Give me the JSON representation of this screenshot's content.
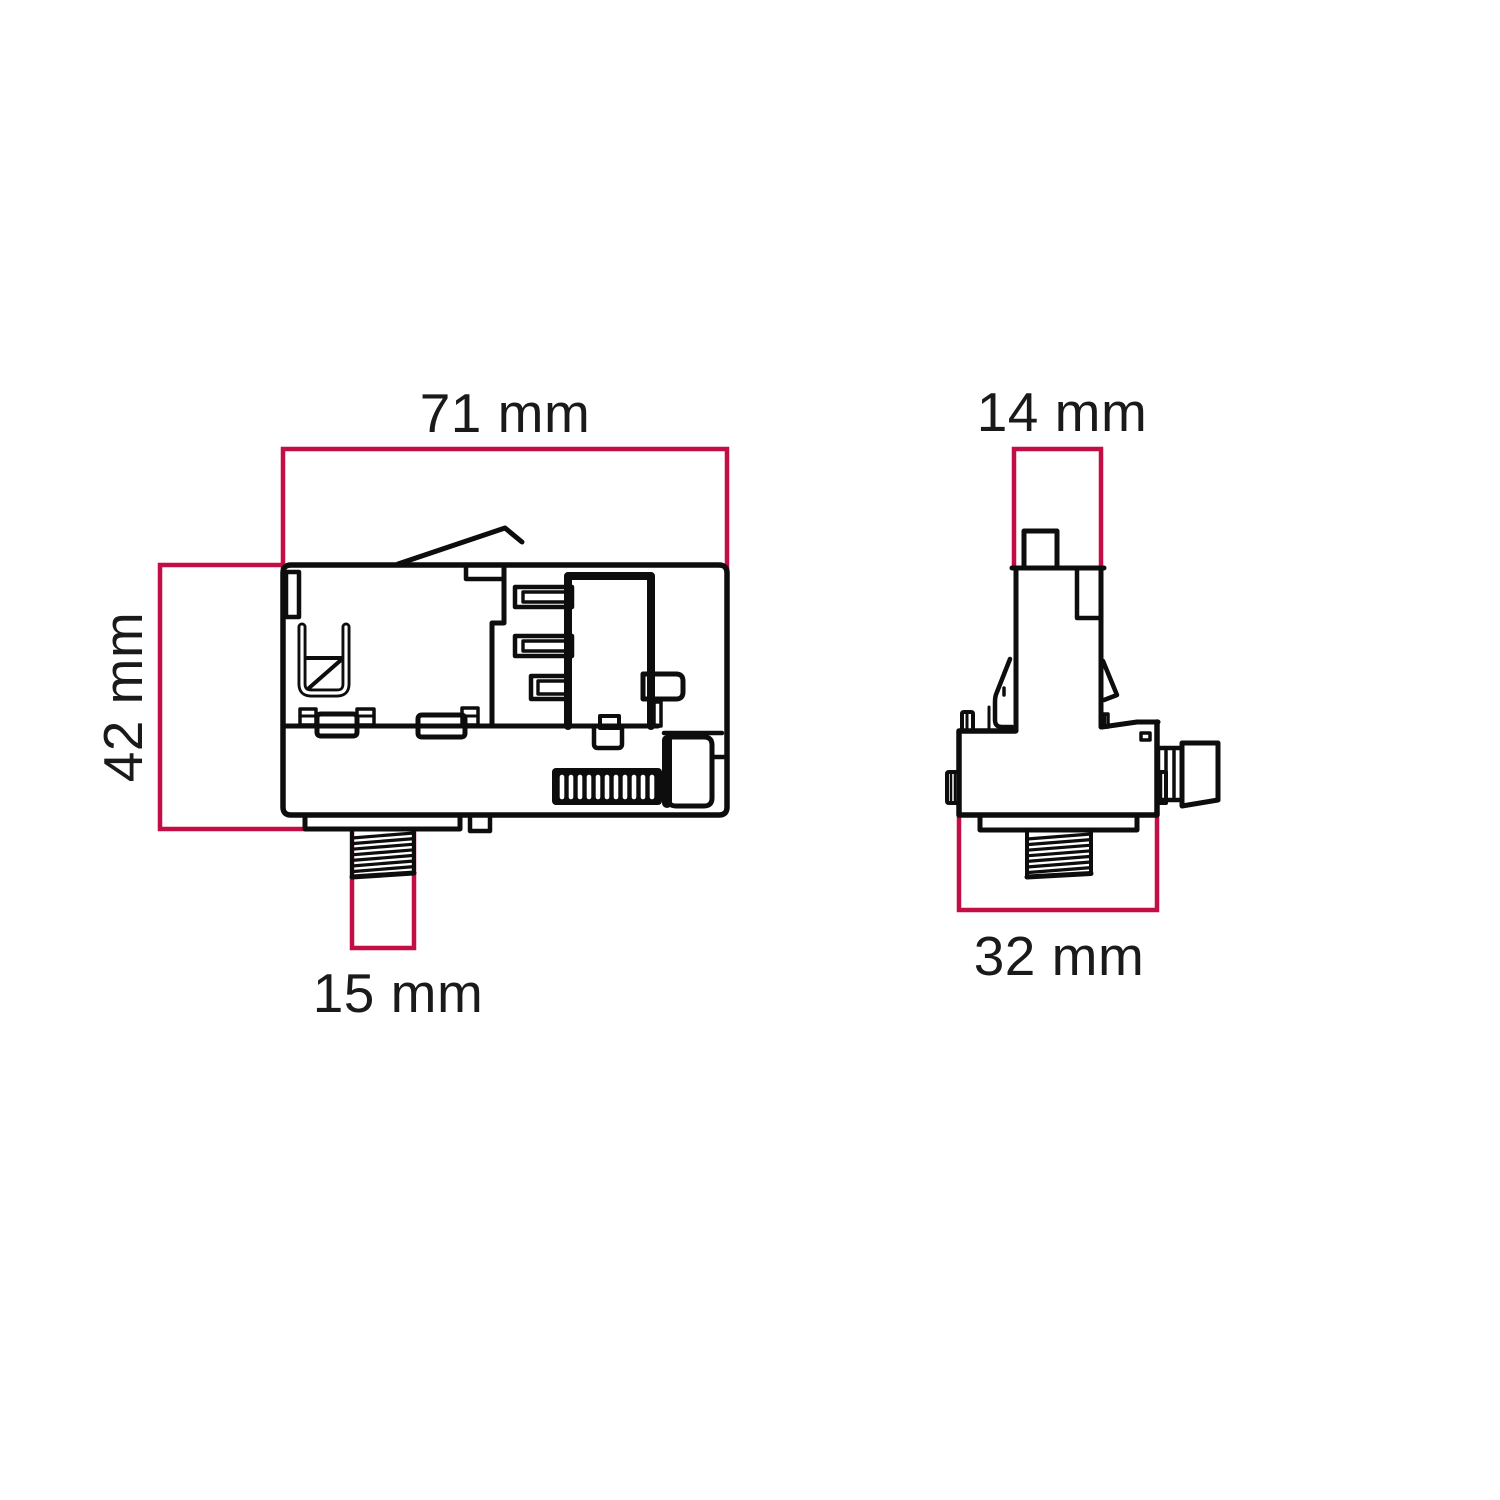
{
  "drawing": {
    "front_view": {
      "width": "71 mm",
      "height": "42 mm",
      "thread": "15 mm"
    },
    "side_view": {
      "top_width": "14 mm",
      "base_width": "32 mm"
    }
  },
  "colors": {
    "dimension_line": "#c30d45",
    "line_art": "#0d0d0d",
    "label_text": "#1a1a1a",
    "background": "#ffffff"
  }
}
